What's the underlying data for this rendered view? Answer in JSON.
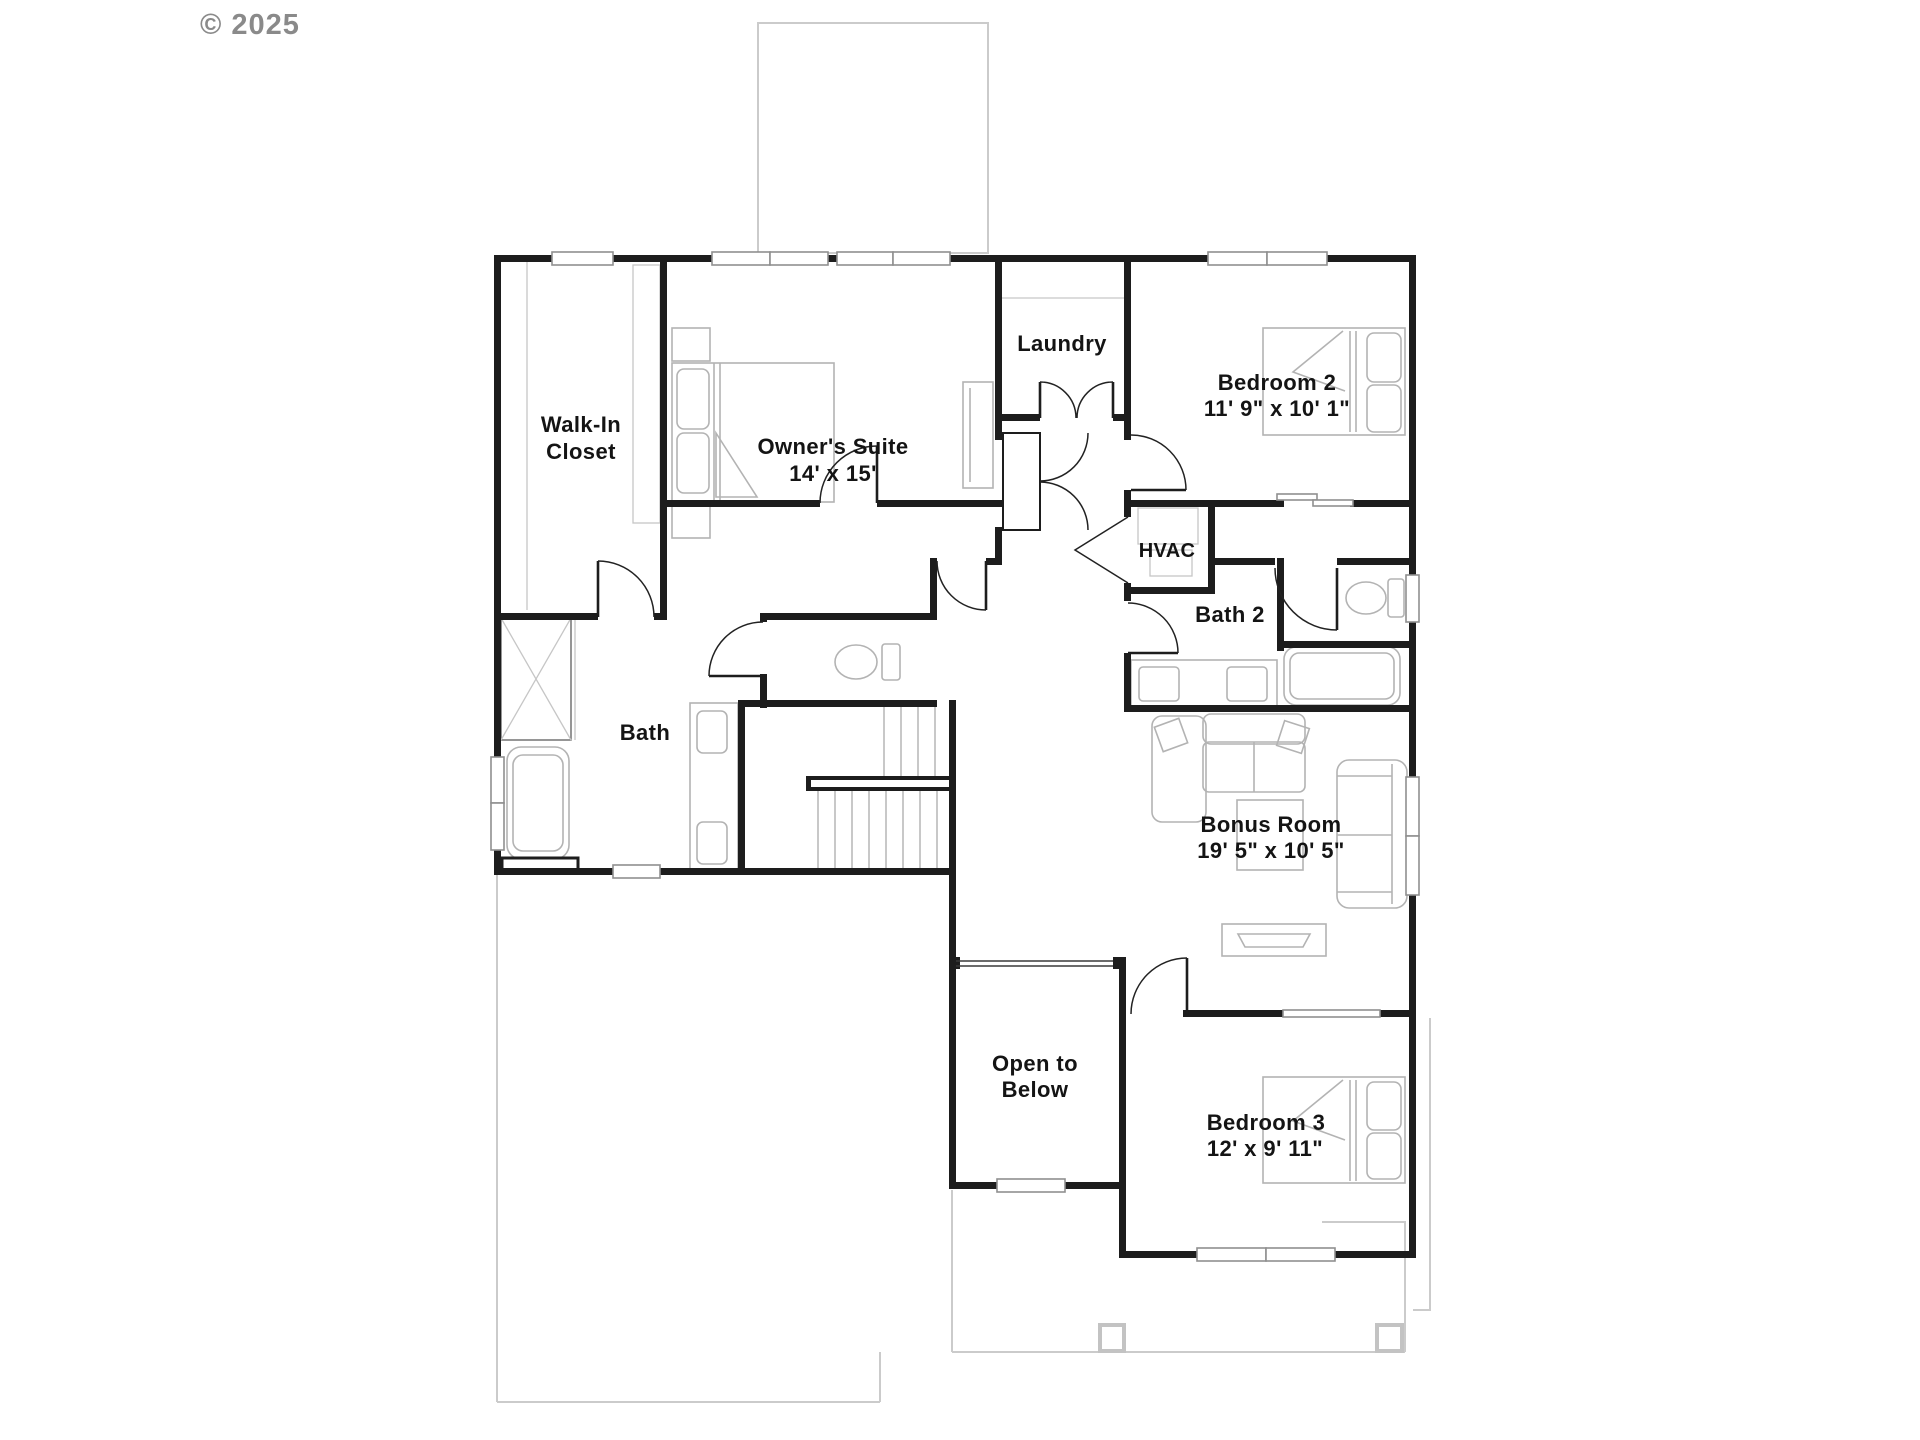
{
  "labels": {
    "copyright": "© 2025",
    "walk_in_closet_1": "Walk-In",
    "walk_in_closet_2": "Closet",
    "owners_suite": "Owner's Suite",
    "owners_suite_dims": "14' x 15'",
    "laundry": "Laundry",
    "bedroom_2": "Bedroom 2",
    "bedroom_2_dims": "11' 9\" x 10' 1\"",
    "hvac": "HVAC",
    "bath_2": "Bath 2",
    "bath": "Bath",
    "bonus_room": "Bonus Room",
    "bonus_room_dims": "19' 5\" x 10' 5\"",
    "open_to_below_1": "Open to",
    "open_to_below_2": "Below",
    "bedroom_3": "Bedroom 3",
    "bedroom_3_dims": "12' x 9' 11\""
  },
  "palette": {
    "wall": "#1d1d1d",
    "ghost_outline": "#cbcbcb",
    "furniture": "#b3b3b3",
    "window_stroke": "#8f8f8f",
    "label_text": "#141414",
    "copyright_text": "#8a8a8a",
    "background": "#ffffff"
  }
}
